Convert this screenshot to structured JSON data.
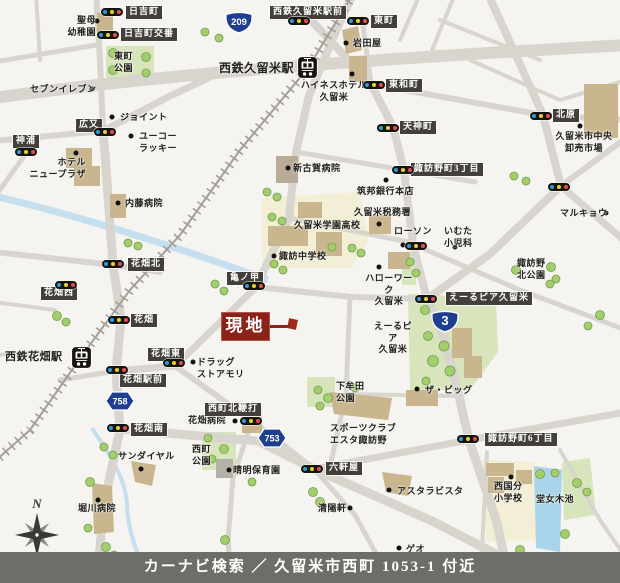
{
  "footer": {
    "text": "カーナビ検索 ／ 久留米市西町 1053-1 付近"
  },
  "site_marker": {
    "label": "現地"
  },
  "compass": {
    "label": "N"
  },
  "route_shields": [
    {
      "number": "209",
      "type": "national",
      "x": 224,
      "y": 10
    },
    {
      "number": "3",
      "type": "national",
      "x": 430,
      "y": 309
    },
    {
      "number": "753",
      "type": "prefectural",
      "x": 257,
      "y": 428
    },
    {
      "number": "758",
      "type": "prefectural",
      "x": 105,
      "y": 391
    }
  ],
  "stations": [
    {
      "x": 297,
      "y": 56
    },
    {
      "x": 71,
      "y": 346
    }
  ],
  "signals": [
    {
      "x": 112,
      "y": 12
    },
    {
      "x": 108,
      "y": 35
    },
    {
      "x": 299,
      "y": 21
    },
    {
      "x": 358,
      "y": 21
    },
    {
      "x": 374,
      "y": 85
    },
    {
      "x": 388,
      "y": 128
    },
    {
      "x": 403,
      "y": 170
    },
    {
      "x": 541,
      "y": 116
    },
    {
      "x": 559,
      "y": 187
    },
    {
      "x": 26,
      "y": 152
    },
    {
      "x": 105,
      "y": 132
    },
    {
      "x": 113,
      "y": 264
    },
    {
      "x": 66,
      "y": 285
    },
    {
      "x": 119,
      "y": 320
    },
    {
      "x": 174,
      "y": 363
    },
    {
      "x": 117,
      "y": 370
    },
    {
      "x": 118,
      "y": 428
    },
    {
      "x": 254,
      "y": 286
    },
    {
      "x": 426,
      "y": 299
    },
    {
      "x": 251,
      "y": 421
    },
    {
      "x": 312,
      "y": 469
    },
    {
      "x": 468,
      "y": 439
    },
    {
      "x": 416,
      "y": 246
    }
  ],
  "signal_labels": [
    {
      "text": "日吉町",
      "x": 126,
      "y": 6
    },
    {
      "text": "日吉町交番",
      "x": 121,
      "y": 28
    },
    {
      "text": "西鉄久留米駅前",
      "x": 270,
      "y": 6
    },
    {
      "text": "東町",
      "x": 371,
      "y": 15
    },
    {
      "text": "東和町",
      "x": 386,
      "y": 79
    },
    {
      "text": "天神町",
      "x": 400,
      "y": 121
    },
    {
      "text": "北原",
      "x": 553,
      "y": 109
    },
    {
      "text": "諏訪野町3丁目",
      "x": 411,
      "y": 163
    },
    {
      "text": "広又",
      "x": 76,
      "y": 119
    },
    {
      "text": "神浦",
      "x": 13,
      "y": 135
    },
    {
      "text": "花畑北",
      "x": 128,
      "y": 258
    },
    {
      "text": "亀ノ甲",
      "x": 227,
      "y": 272
    },
    {
      "text": "花畑西",
      "x": 41,
      "y": 287
    },
    {
      "text": "花畑",
      "x": 131,
      "y": 314
    },
    {
      "text": "花畑東",
      "x": 148,
      "y": 348
    },
    {
      "text": "花畑駅前",
      "x": 120,
      "y": 374
    },
    {
      "text": "花畑南",
      "x": 131,
      "y": 423
    },
    {
      "text": "えーるピア久留米",
      "x": 446,
      "y": 292
    },
    {
      "text": "西町北鞭打",
      "x": 205,
      "y": 403
    },
    {
      "text": "六軒屋",
      "x": 326,
      "y": 462
    },
    {
      "text": "諏訪野町6丁目",
      "x": 485,
      "y": 433
    }
  ],
  "pois": [
    {
      "text": "聖母\n幼稚園",
      "x": 44,
      "y": 15,
      "w": 52,
      "align": "right",
      "dot": {
        "x": 97,
        "y": 21
      }
    },
    {
      "text": "セブンイレブン",
      "x": 30,
      "y": 84,
      "dot": {
        "x": 92,
        "y": 89
      }
    },
    {
      "text": "ジョイント",
      "x": 120,
      "y": 112,
      "dot": {
        "x": 112,
        "y": 117
      }
    },
    {
      "text": "ユーコー\nラッキー",
      "x": 139,
      "y": 131,
      "dot": {
        "x": 131,
        "y": 136
      }
    },
    {
      "text": "ホテル\nニュープラザ",
      "x": 28,
      "y": 157,
      "w": 58,
      "align": "right",
      "dot": {
        "x": 76,
        "y": 153
      }
    },
    {
      "text": "内藤病院",
      "x": 125,
      "y": 198,
      "dot": {
        "x": 118,
        "y": 203
      }
    },
    {
      "text": "岩田屋",
      "x": 353,
      "y": 38,
      "dot": {
        "x": 346,
        "y": 43
      }
    },
    {
      "text": "ハイネスホテル\n久留米",
      "x": 300,
      "y": 80,
      "w": 68,
      "align": "center",
      "dot": {
        "x": 352,
        "y": 74
      }
    },
    {
      "text": "久留米市中央\n卸売市場",
      "x": 551,
      "y": 131,
      "w": 66,
      "align": "center",
      "dot": {
        "x": 580,
        "y": 126
      }
    },
    {
      "text": "新古賀病院",
      "x": 293,
      "y": 163,
      "dot": {
        "x": 288,
        "y": 168
      }
    },
    {
      "text": "筑邦銀行本店",
      "x": 357,
      "y": 186,
      "dot": {
        "x": 386,
        "y": 180
      }
    },
    {
      "text": "久留米税務署",
      "x": 354,
      "y": 207,
      "dot": {
        "x": 379,
        "y": 224
      }
    },
    {
      "text": "久留米学園高校",
      "x": 294,
      "y": 220
    },
    {
      "text": "マルキョウ",
      "x": 560,
      "y": 208,
      "dot": {
        "x": 606,
        "y": 213
      }
    },
    {
      "text": "ローソン",
      "x": 394,
      "y": 226,
      "dot": {
        "x": 403,
        "y": 245
      }
    },
    {
      "text": "いむた\n小児科",
      "x": 444,
      "y": 226,
      "dot": {
        "x": 455,
        "y": 247
      }
    },
    {
      "text": "諏訪中学校",
      "x": 279,
      "y": 251,
      "dot": {
        "x": 274,
        "y": 256
      }
    },
    {
      "text": "ハローワーク\n久留米",
      "x": 364,
      "y": 273,
      "w": 50,
      "align": "center",
      "dot": {
        "x": 379,
        "y": 267
      }
    },
    {
      "text": "諏訪野\n北公園",
      "x": 517,
      "y": 258
    },
    {
      "text": "えーるピア\n久留米",
      "x": 370,
      "y": 321,
      "w": 46,
      "align": "center"
    },
    {
      "text": "ドラッグ\nストアモリ",
      "x": 197,
      "y": 357,
      "dot": {
        "x": 193,
        "y": 362
      }
    },
    {
      "text": "下牟田\n公園",
      "x": 336,
      "y": 381
    },
    {
      "text": "ザ・ビッグ",
      "x": 425,
      "y": 385,
      "dot": {
        "x": 417,
        "y": 389
      }
    },
    {
      "text": "スポーツクラブ\nエスタ諏訪野",
      "x": 330,
      "y": 423
    },
    {
      "text": "花畑病院",
      "x": 188,
      "y": 415,
      "dot": {
        "x": 235,
        "y": 421
      }
    },
    {
      "text": "サンダイヤル",
      "x": 118,
      "y": 451,
      "dot": {
        "x": 141,
        "y": 469
      }
    },
    {
      "text": "西町\n公園",
      "x": 192,
      "y": 444
    },
    {
      "text": "晴明保育園",
      "x": 233,
      "y": 465,
      "dot": {
        "x": 229,
        "y": 470
      }
    },
    {
      "text": "アスタラビスタ",
      "x": 397,
      "y": 486,
      "dot": {
        "x": 389,
        "y": 490
      }
    },
    {
      "text": "堀川病院",
      "x": 78,
      "y": 503,
      "dot": {
        "x": 98,
        "y": 500
      }
    },
    {
      "text": "清陽軒",
      "x": 318,
      "y": 503,
      "dot": {
        "x": 350,
        "y": 508
      }
    },
    {
      "text": "西国分\n小学校",
      "x": 494,
      "y": 481,
      "dot": {
        "x": 511,
        "y": 477
      }
    },
    {
      "text": "堂女木池",
      "x": 536,
      "y": 494
    },
    {
      "text": "ゲオ",
      "x": 406,
      "y": 544,
      "dot": {
        "x": 399,
        "y": 548
      }
    },
    {
      "text": "西鉄久留米駅",
      "x": 219,
      "y": 61,
      "size": 12
    },
    {
      "text": "西鉄花畑駅",
      "x": 5,
      "y": 350,
      "size": 11
    },
    {
      "text": "東町\n公園",
      "x": 114,
      "y": 51
    }
  ]
}
